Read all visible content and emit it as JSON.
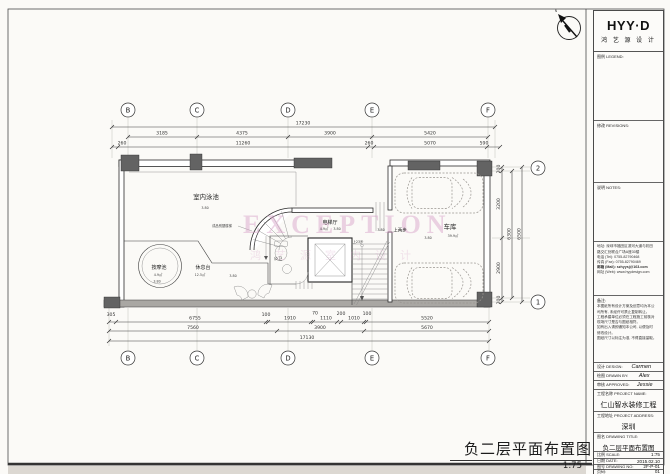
{
  "brand": {
    "name": "HYY·D",
    "cn": "鸿 艺 源 设 计"
  },
  "titleblock": {
    "legend_label": "图例 LEGEND:",
    "revisions_label": "修改 REVISIONS:",
    "notes_label": "说明 NOTES:",
    "contact_lines": [
      "地址: 深圳市福田区滨河大道与彩田",
      "路交汇处联合广场A座30楼",
      "电话 (Tel): 0755-82790468",
      "传真 (Fax): 0755-82790469",
      "邮箱 (Mail): szhyysj@163.com",
      "网址 (Web): www.hyydesign.com"
    ],
    "remark_label": "备注:",
    "remark_lines": [
      "本图纸所有设计方案及创意均为本公",
      "司所有, 未经许可禁止复制转让。",
      "工程承建单位必须在工程施工前核对",
      "现场尺寸是否与图纸相符。",
      "如有出入请即通知本公司, 以便及时",
      "修改设计。",
      "图纸尺寸以标注为准, 不得直接量取。"
    ],
    "design_label": "设计 DESIGN:",
    "design": "Carmen",
    "drawn_label": "绘图 DRAWN BY:",
    "drawn": "Alex",
    "approved_label": "审核 APPROVED:",
    "approved": "Jessie",
    "pname_label": "工程名称 PROJECT NAME:",
    "pname": "仁山智水装修工程",
    "paddr_label": "工程地址 PROJECT ADDRESS:",
    "paddr": "深圳",
    "dtitle_label": "图名 DRAWING TITLE:",
    "dtitle": "负二层平面布置图",
    "scale_label": "比例 SCALE:",
    "scale": "1:75",
    "date_label": "日期 DATE:",
    "date": "2015.02.10",
    "no_label": "图号 DRAWING NO:",
    "no": "2F-P-01",
    "page_label": "页码:",
    "page": "01"
  },
  "footer": {
    "title": "负二层平面布置图",
    "scale": "1:75"
  },
  "north": {
    "label": "N"
  },
  "watermark": {
    "line1": "EXCEPTION",
    "line2": "鸿艺源室内设计"
  },
  "grid": {
    "top": [
      "B",
      "C",
      "D",
      "E",
      "F"
    ],
    "right": [
      "2",
      "1"
    ]
  },
  "dims": {
    "top": {
      "overall": "17230",
      "row2": [
        "3185",
        "4375",
        "3900",
        "5420"
      ],
      "row3": [
        "260",
        "11260",
        "260",
        "5070",
        "590"
      ]
    },
    "bottom": {
      "row1": [
        "305",
        "6755",
        "100",
        "1910",
        "70",
        "1110",
        "200",
        "1010",
        "100",
        "5520"
      ],
      "row2": [
        "7560",
        "3900",
        "5670"
      ],
      "overall": "17130"
    },
    "right": {
      "row1": [
        "200",
        "3200",
        "2900",
        "200"
      ],
      "mid": "6300",
      "overall": "6500"
    }
  },
  "rooms": {
    "pool": {
      "name": "室内泳池",
      "level": "3.80"
    },
    "stair_note": {
      "name": "成品别墅楼梯"
    },
    "elevator_hall": {
      "name": "电梯厅",
      "area": "4.9㎡",
      "level": "3.80"
    },
    "up_two": {
      "name": "上两步",
      "level": "3.80"
    },
    "up_23": {
      "name": "上23步"
    },
    "bath": {
      "name": "公卫"
    },
    "massage": {
      "name": "按摩池",
      "area": "4.9㎡",
      "level": "3.80"
    },
    "rest": {
      "name": "休息台",
      "area": "12.5㎡",
      "level": "3.80"
    },
    "garage": {
      "name": "车库",
      "area": "39.9㎡",
      "level": "3.80"
    }
  }
}
